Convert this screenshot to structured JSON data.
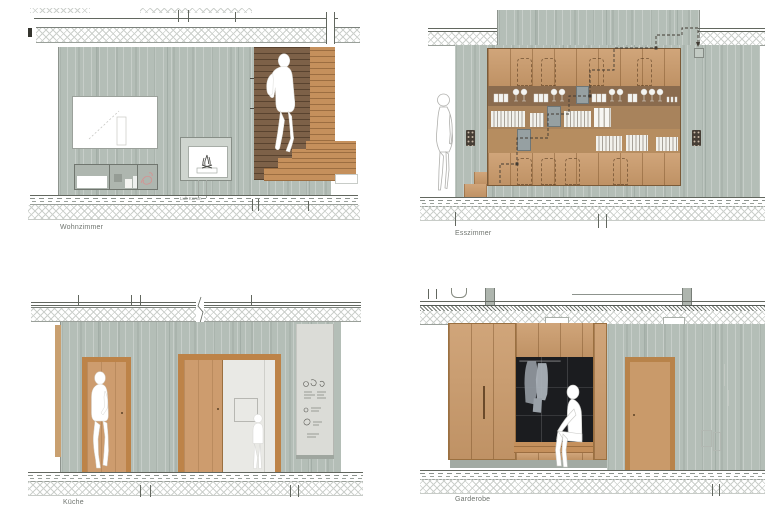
{
  "sheet": {
    "rooms": [
      {
        "label": "Wohnzimmer"
      },
      {
        "label": "Esszimmer"
      },
      {
        "label": "Küche"
      },
      {
        "label": "Garderobe"
      }
    ],
    "annotation_fireplace": "Luft Kamin"
  },
  "colors": {
    "concrete": "#b4beb7",
    "wood": "#cb9b6b",
    "wood_frame": "#bd8348",
    "stair_shadow": "#7d6148",
    "wardrobe_niche": "#1b1c1f",
    "board": "#dbdcd7",
    "drawing_line": "#62675f",
    "label_text": "#6f746f"
  }
}
